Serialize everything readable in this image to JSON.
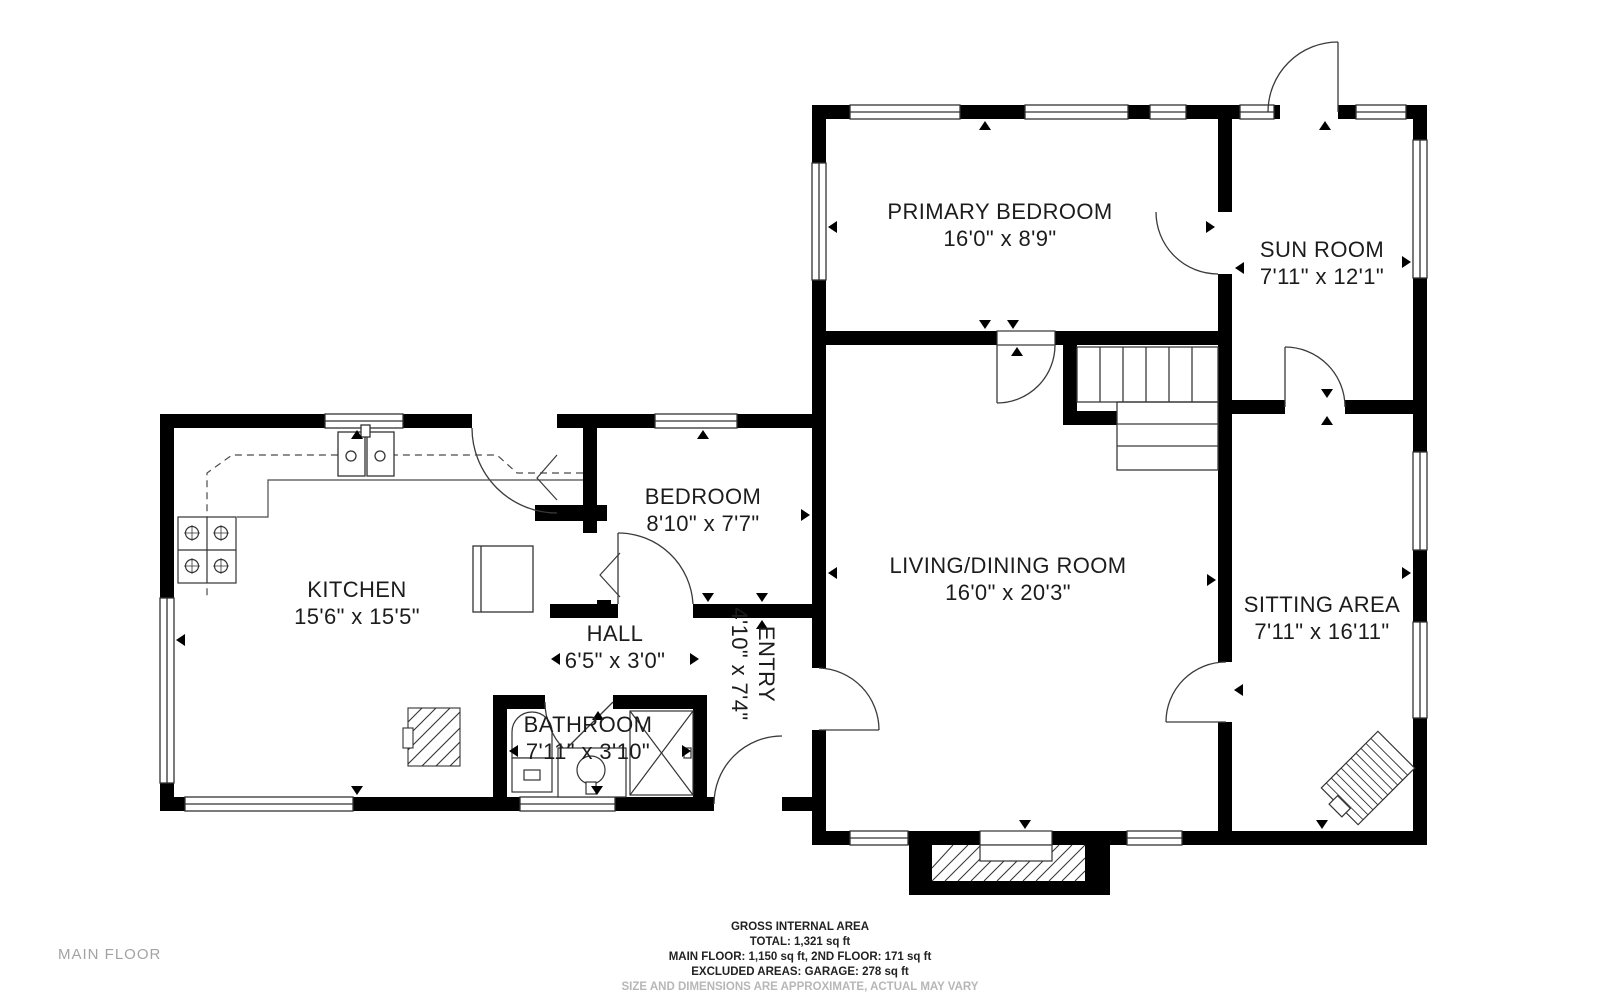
{
  "plan": {
    "floor_label": "MAIN FLOOR",
    "rooms": [
      {
        "id": "primary-bedroom",
        "name": "PRIMARY BEDROOM",
        "dims": "16'0\" x 8'9\""
      },
      {
        "id": "sun-room",
        "name": "SUN ROOM",
        "dims": "7'11\" x 12'1\""
      },
      {
        "id": "kitchen",
        "name": "KITCHEN",
        "dims": "15'6\" x 15'5\""
      },
      {
        "id": "bedroom",
        "name": "BEDROOM",
        "dims": "8'10\" x 7'7\""
      },
      {
        "id": "hall",
        "name": "HALL",
        "dims": "6'5\" x 3'0\""
      },
      {
        "id": "bathroom",
        "name": "BATHROOM",
        "dims": "7'11\" x 3'10\""
      },
      {
        "id": "entry",
        "name": "ENTRY",
        "dims": "4'10\" x 7'4\""
      },
      {
        "id": "living-dining",
        "name": "LIVING/DINING ROOM",
        "dims": "16'0\" x 20'3\""
      },
      {
        "id": "sitting-area",
        "name": "SITTING AREA",
        "dims": "7'11\" x 16'11\""
      }
    ],
    "footer": {
      "title": "GROSS INTERNAL AREA",
      "total": "TOTAL: 1,321 sq ft",
      "floors": "MAIN FLOOR: 1,150 sq ft, 2ND FLOOR: 171 sq ft",
      "excluded": "EXCLUDED AREAS: GARAGE: 278 sq ft",
      "disclaimer": "SIZE AND DIMENSIONS ARE APPROXIMATE, ACTUAL MAY VARY"
    },
    "colors": {
      "wall": "#000000",
      "line": "#333333",
      "label_text": "#1c1c1c",
      "muted_text": "#a3a3a3",
      "disclaimer_text": "#b7b7b7"
    }
  }
}
